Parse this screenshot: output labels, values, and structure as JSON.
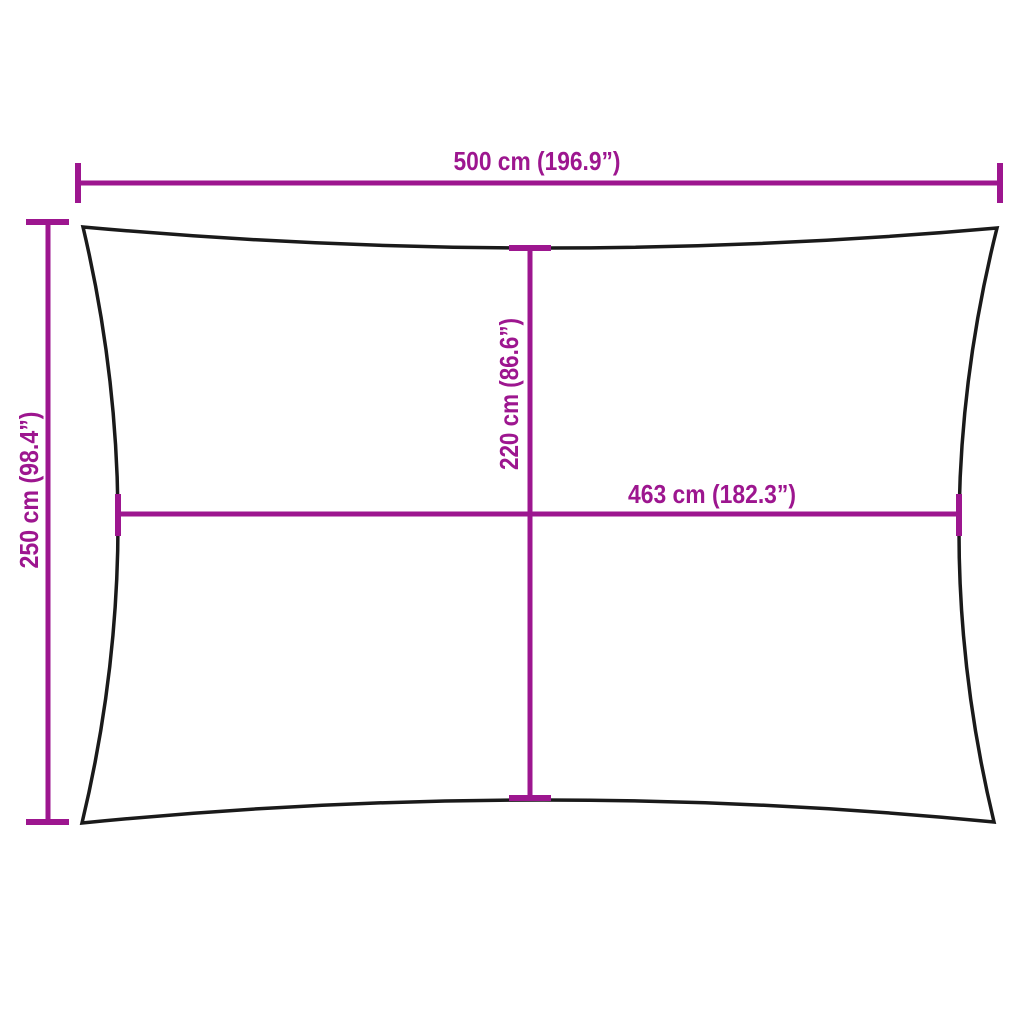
{
  "diagram": {
    "name": "rectangular-shade-sail-dimension-diagram",
    "colors": {
      "background": "#ffffff",
      "outline": "#1a1a1a",
      "dimension": "#9D168F"
    },
    "dimensions": {
      "width": {
        "label": "500 cm (196.9”)",
        "cm": 500,
        "inches": 196.9
      },
      "height": {
        "label": "250 cm (98.4”)",
        "cm": 250,
        "inches": 98.4
      },
      "inner_height": {
        "label": "220 cm (86.6”)",
        "cm": 220,
        "inches": 86.6
      },
      "inner_width": {
        "label": "463 cm (182.3”)",
        "cm": 463,
        "inches": 182.3
      }
    }
  }
}
